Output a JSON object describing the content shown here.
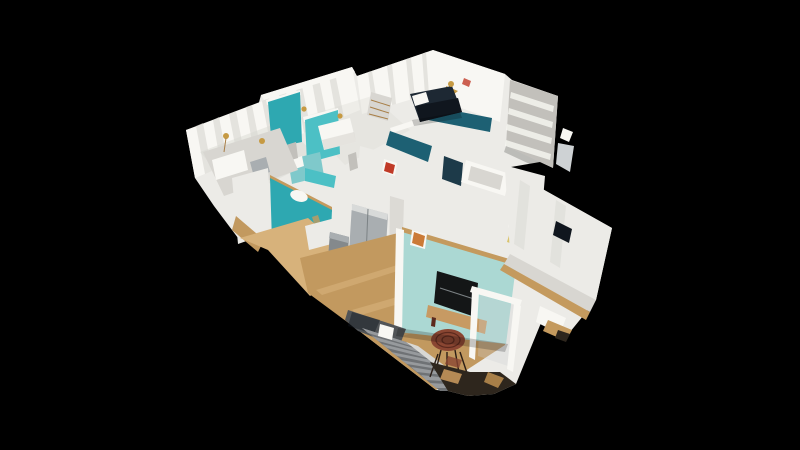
{
  "viewer": {
    "type": "3d-dollhouse-view",
    "background": "#000000",
    "visible_text": [],
    "scene_features": [
      "curtained exterior wall",
      "teal accent walls",
      "teal wall with oval cutout",
      "bedroom with white bed",
      "bedroom with pale-teal bed",
      "bedroom with navy bed",
      "deep-teal accent wall",
      "white bathroom with tub and toilet",
      "shelving unit",
      "kitchen with fridge and trash bin",
      "wood desk with black office chair",
      "pale-aqua living room wall",
      "wall-mounted tv",
      "wood tv console",
      "round mahogany table",
      "gray staircase with landing",
      "white stair railing frame",
      "large white exterior wall with dark picture",
      "tan cut edges",
      "scan debris at bottom",
      "floating scan shards"
    ]
  },
  "colors": {
    "bg": "#000000",
    "wallWhite": "#ecebe7",
    "wallBright": "#f8f7f3",
    "wallShade": "#d8d6d1",
    "wallDim": "#c2c0bb",
    "cutTan": "#c49a5e",
    "cutTanDark": "#a87f48",
    "floorWood": "#c2995f",
    "floorWoodLight": "#d7b27b",
    "floorWoodDark": "#a57c4b",
    "tealBright": "#2ea8b1",
    "tealBright2": "#4cc0c5",
    "tealSoft": "#7fc9cb",
    "tealPale": "#abd8d3",
    "tealDeep": "#1d6073",
    "glassDark": "#1d3a49",
    "navy": "#1d2833",
    "navyDark": "#10161e",
    "appliance": "#a9aeb1",
    "applianceDark": "#84898c",
    "stairLanding": "#515457",
    "stairRiser": "#6f7275",
    "stairTread": "#979a9d",
    "stairStringer": "#d9d8d4",
    "tableWood": "#8a4632",
    "tableWoodDark": "#5c2a1e",
    "tvBlack": "#141617",
    "consoleWood": "#c79a63",
    "gold": "#c69a43",
    "goldSoft": "#d9c36a",
    "redSign": "#c03a27",
    "orangeArt": "#cb7a36",
    "rubbleDark": "#2e261d",
    "rubbleTan": "#b58a55",
    "shardGray": "#ced2d4",
    "chairBlack": "#232322"
  }
}
